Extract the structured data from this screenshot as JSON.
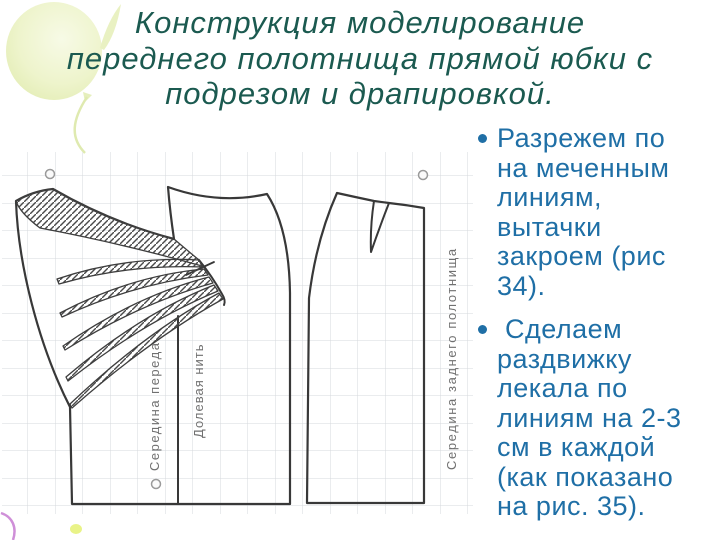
{
  "title": {
    "color": "#1b5a50",
    "lines": [
      "Конструкция моделирование",
      "переднего полотнища прямой юбки с",
      "подрезом и драпировкой."
    ]
  },
  "content": {
    "text_color": "#1f6fa6",
    "bullets": [
      {
        "lines": [
          "Разрежем по",
          "на меченным",
          "линиям,",
          "вытачки",
          "закроем (рис",
          "34)."
        ]
      },
      {
        "lines": [
          " Сделаем",
          "раздвижку",
          "лекала по",
          "линиям на 2-3",
          "см в каждой",
          "(как показано",
          "на рис. 35)."
        ]
      }
    ]
  },
  "diagram": {
    "labels": {
      "center_front": "Середина переда",
      "grain_line": "Долевая нить",
      "center_back": "Середина заднего полотнища"
    },
    "colors": {
      "outline": "#383838",
      "grid": "#d5d8dc",
      "label": "#707070"
    }
  }
}
